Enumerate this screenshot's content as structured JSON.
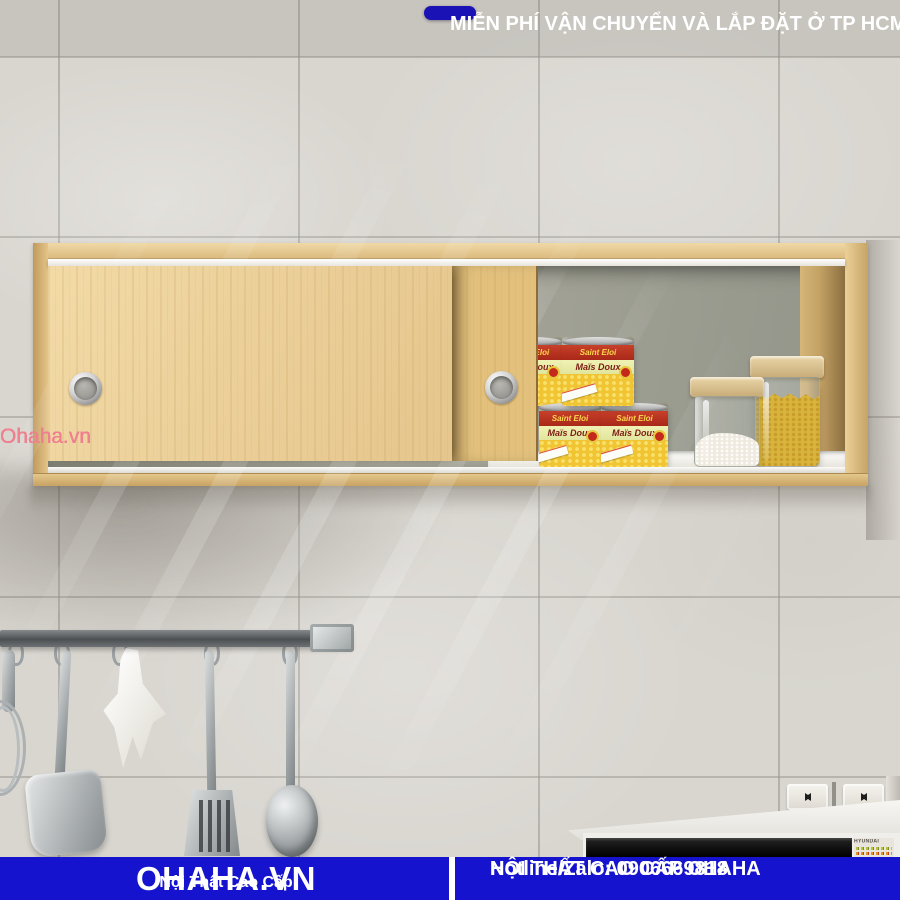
{
  "top_banner": {
    "label": "MIỄN PHÍ VẬN CHUYỂN VÀ LẮP ĐẶT Ở TP HCM",
    "bg_color": "#1b12b5",
    "text_color": "#ffffff"
  },
  "bottom_banner": {
    "brand": "OHAHA.VN",
    "tagline": "Nội Thất Cao Cấp",
    "store_line": "NỘI THẤT CAO CẤP OHAHA",
    "hotline_line": "Hotline/Zalo: 0906669818",
    "bg_color": "#1513cd",
    "text_color": "#ffffff"
  },
  "watermark": {
    "text": "Ohaha.vn",
    "color": "#ef8090"
  },
  "products": {
    "can_brand": "Saint Eloi",
    "can_name": "Maïs Doux"
  },
  "appliance": {
    "brand": "HYUNDAI"
  },
  "scene": {
    "cabinet_wood_color": "#ecd29b",
    "interior_back_color": "#a6a699",
    "wall_color": "#d9d6d0"
  }
}
